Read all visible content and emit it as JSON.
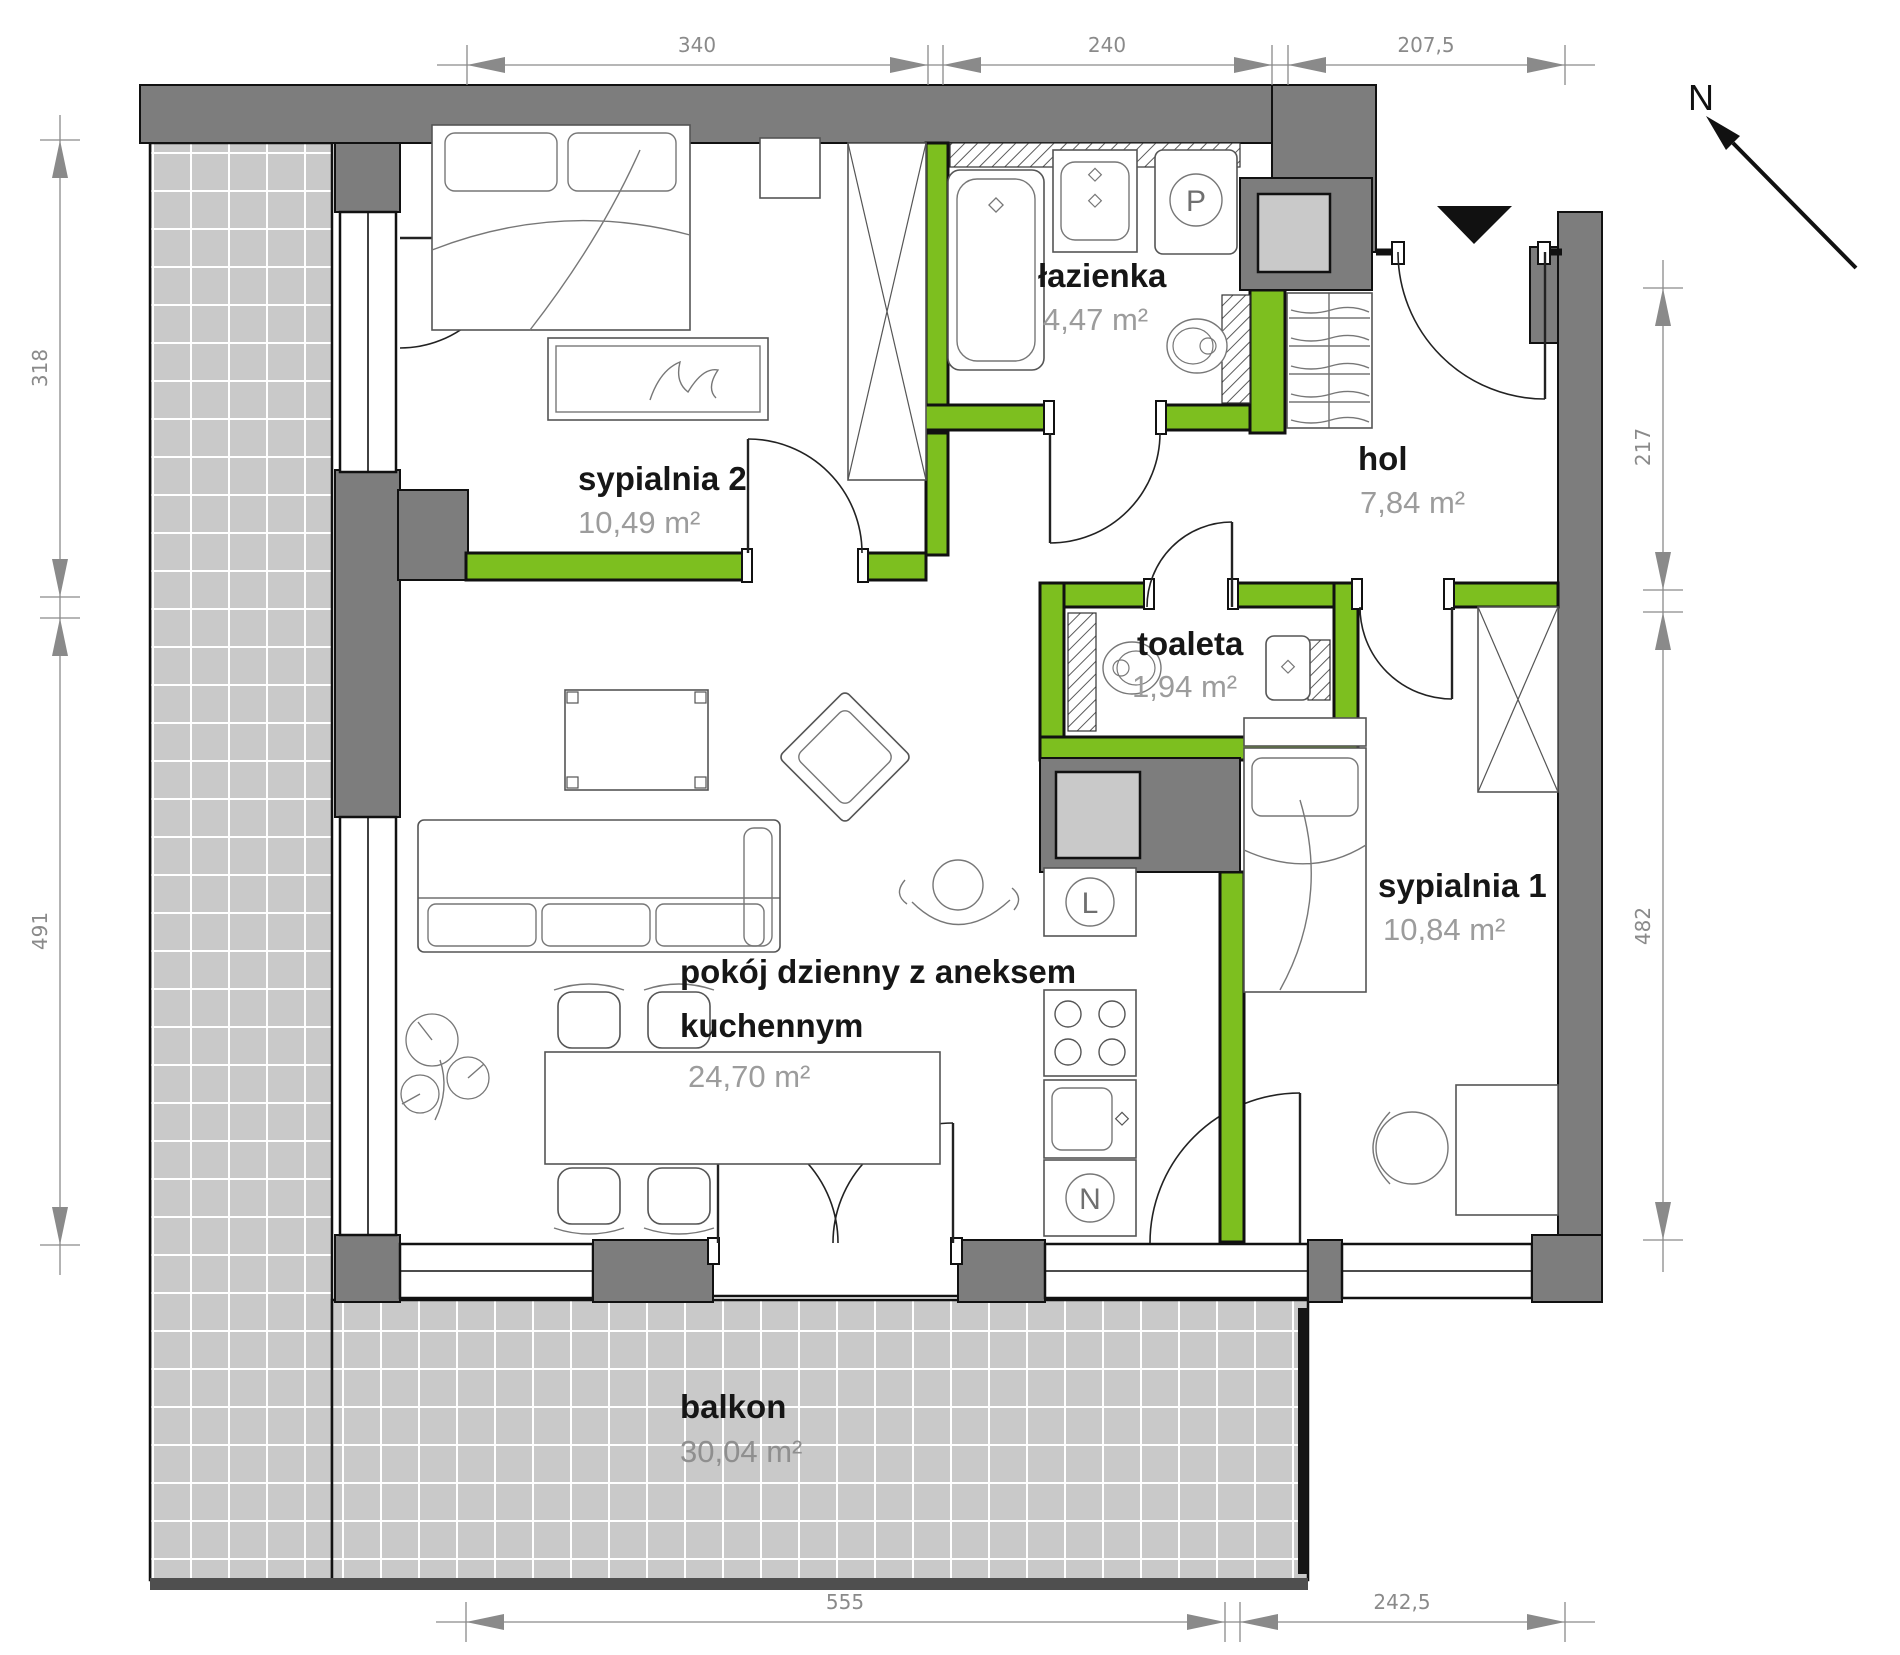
{
  "compass": {
    "label": "N"
  },
  "rooms": {
    "sypialnia2": {
      "name": "sypialnia 2",
      "area": "10,49 m²"
    },
    "lazienka": {
      "name": "łazienka",
      "area": "4,47 m²"
    },
    "hol": {
      "name": "hol",
      "area": "7,84 m²"
    },
    "toaleta": {
      "name": "toaleta",
      "area": "1,94 m²"
    },
    "sypialnia1": {
      "name": "sypialnia 1",
      "area": "10,84 m²"
    },
    "living": {
      "name_line1": "pokój dzienny z aneksem",
      "name_line2": "kuchennym",
      "area": "24,70 m²"
    },
    "balkon": {
      "name": "balkon",
      "area": "30,04 m²"
    }
  },
  "appliances": {
    "washer_label": "P",
    "fridge_label": "L",
    "dishwasher_label": "N"
  },
  "dimensions": {
    "top": [
      "340",
      "240",
      "207,5"
    ],
    "bottom": [
      "555",
      "242,5"
    ],
    "left": [
      "318",
      "491"
    ],
    "right": [
      "217",
      "482"
    ]
  },
  "colors": {
    "accent_green": "#7dbf1f",
    "wall_gray": "#7d7d7d",
    "tile_gray": "#c9c9c9",
    "room_name_text": "#161616",
    "area_text": "#9c9c9c",
    "dimension_text": "#8a8a8a"
  }
}
